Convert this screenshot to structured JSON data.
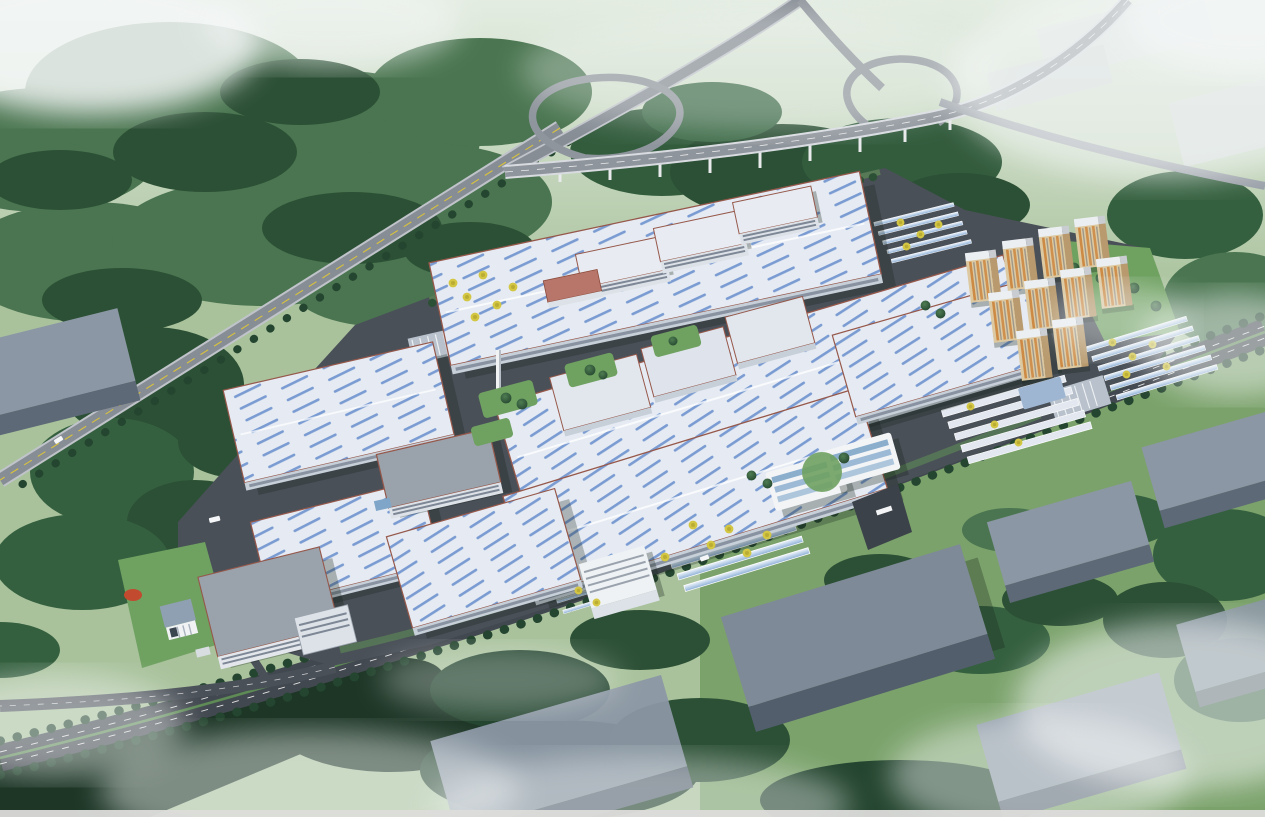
{
  "scene": {
    "description": "Bird's-eye architectural rendering of a large industrial park campus: white factory halls with blue skylight strips and red trim, dormitory and office blocks, ten beige residential towers with orange accents, solar carport rows with yellow ginkgo trees, a looping highway interchange at top, tree-lined boulevard with green median along the south edge, untextured gray context massing blocks, dense forest and drifting mist at the image edges.",
    "view": "high oblique aerial, daytime, hazy scan",
    "text_visible": "none (no legible labels in image)"
  },
  "palette": {
    "ground_green": "#a9c29c",
    "ground_light": "#cfdcc6",
    "lawn_green": "#6fa161",
    "forest_mid": "#4a7550",
    "forest_dark": "#2c5035",
    "forest_deep": "#1d3626",
    "asphalt": "#4a5058",
    "road_dark": "#42484f",
    "highway_gray": "#878d95",
    "highway_edge": "#d3d6da",
    "lane_yellow": "#d8c23c",
    "median_green": "#5d8a55",
    "roof_white": "#e6ebf3",
    "skylight_blue": "#6f94cf",
    "trim_red": "#96584a",
    "wall_white": "#c7cfd9",
    "window_band": "#7d8795",
    "residential_beige": "#dcc9a2",
    "residential_orange": "#cd8a44",
    "massing_gray": "#8b97a4",
    "massing_front": "#5d6977",
    "glass_blue": "#7fa6c9",
    "yellow_tree": "#d3c643",
    "mist_white": "#f4f7f7",
    "scan_strip": "#dcdcda"
  },
  "inventory": {
    "highway_interchange": {
      "loops": 2,
      "elevated_viaduct": true,
      "piers": 9
    },
    "factory_halls_large": 7,
    "support_buildings": 12,
    "residential_towers": 10,
    "carport_clusters": 5,
    "dormitory_shed_rows": 5,
    "context_massing_blocks": 7,
    "faded_background_blocks": 3,
    "vehicles": 3,
    "chimney": 1,
    "entrance_gates": 2
  }
}
